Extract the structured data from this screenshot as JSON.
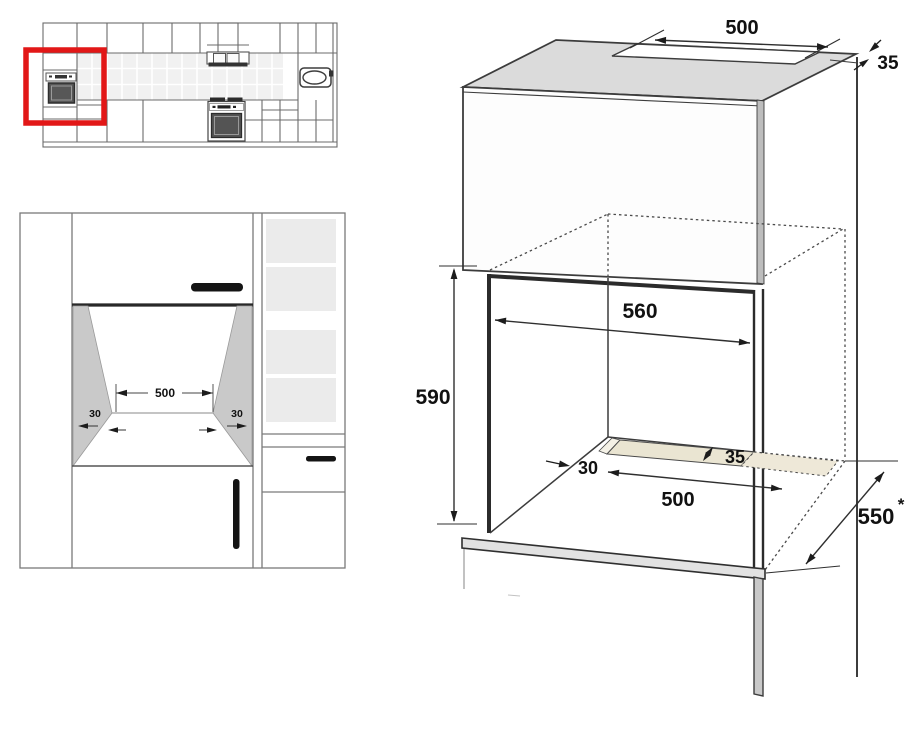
{
  "front_view": {
    "opening_width": "500",
    "left_clearance": "30",
    "right_clearance": "30"
  },
  "isometric": {
    "top_vent_width": "500",
    "rear_gap": "35",
    "niche_width": "560",
    "niche_height": "590",
    "slot_side_offset": "30",
    "bottom_vent_width": "500",
    "bottom_vent_depth": "35",
    "cabinet_depth": "550",
    "depth_note": "*"
  },
  "colors": {
    "highlight_red": "#e21717",
    "vent_strip_beige": "#eae5d2",
    "top_panel_gray": "#dbdbdb",
    "niche_wall_gray": "#c9c9c9",
    "line_gray": "#3c3c3c"
  }
}
